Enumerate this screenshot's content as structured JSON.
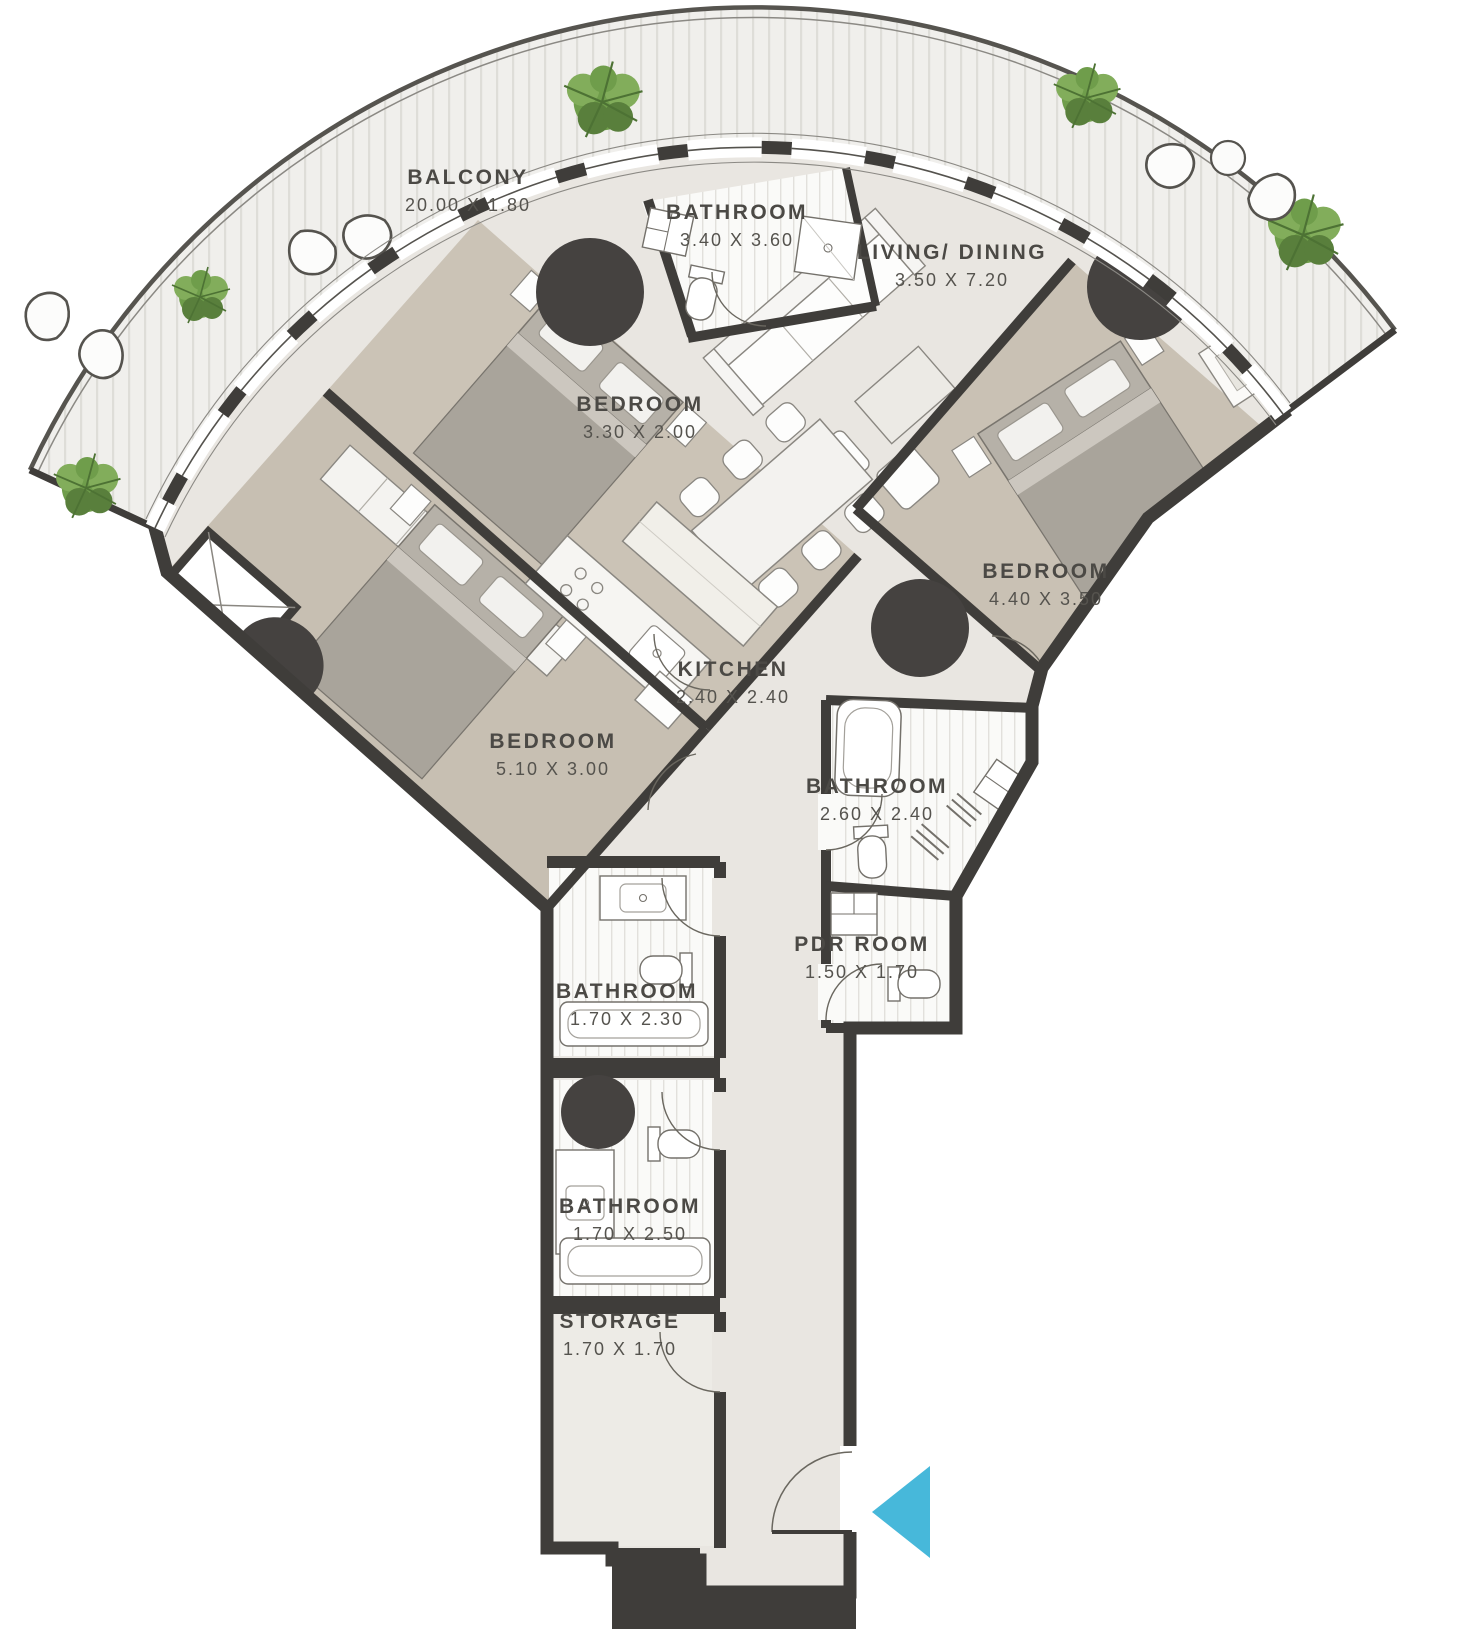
{
  "plan": {
    "type": "apartment-floor-plan",
    "rooms": [
      {
        "name": "BALCONY",
        "dims": "20.00 X 1.80"
      },
      {
        "name": "BATHROOM",
        "dims": "3.40 X 3.60"
      },
      {
        "name": "LIVING/ DINING",
        "dims": "3.50 X 7.20"
      },
      {
        "name": "BEDROOM",
        "dims": "3.30 X 2.00"
      },
      {
        "name": "BEDROOM",
        "dims": "4.40 X 3.50"
      },
      {
        "name": "KITCHEN",
        "dims": "2.40 X 2.40"
      },
      {
        "name": "BEDROOM",
        "dims": "5.10 X 3.00"
      },
      {
        "name": "BATHROOM",
        "dims": "2.60 X 2.40"
      },
      {
        "name": "PDR ROOM",
        "dims": "1.50 X 1.70"
      },
      {
        "name": "BATHROOM",
        "dims": "1.70 X 2.30"
      },
      {
        "name": "BATHROOM",
        "dims": "1.70 X 2.50"
      },
      {
        "name": "STORAGE",
        "dims": "1.70 X 1.70"
      }
    ],
    "icons": {
      "entrance_arrow": "left-pointing-triangle"
    },
    "colors": {
      "wall": "#3f3d3a",
      "floor": "#e9e6e1",
      "carpet": "#c7bfb2",
      "deck": "#f0efec",
      "plant": "#6f9d4b",
      "entrance_arrow": "#47b8da",
      "label_text": "#4b4945"
    }
  }
}
